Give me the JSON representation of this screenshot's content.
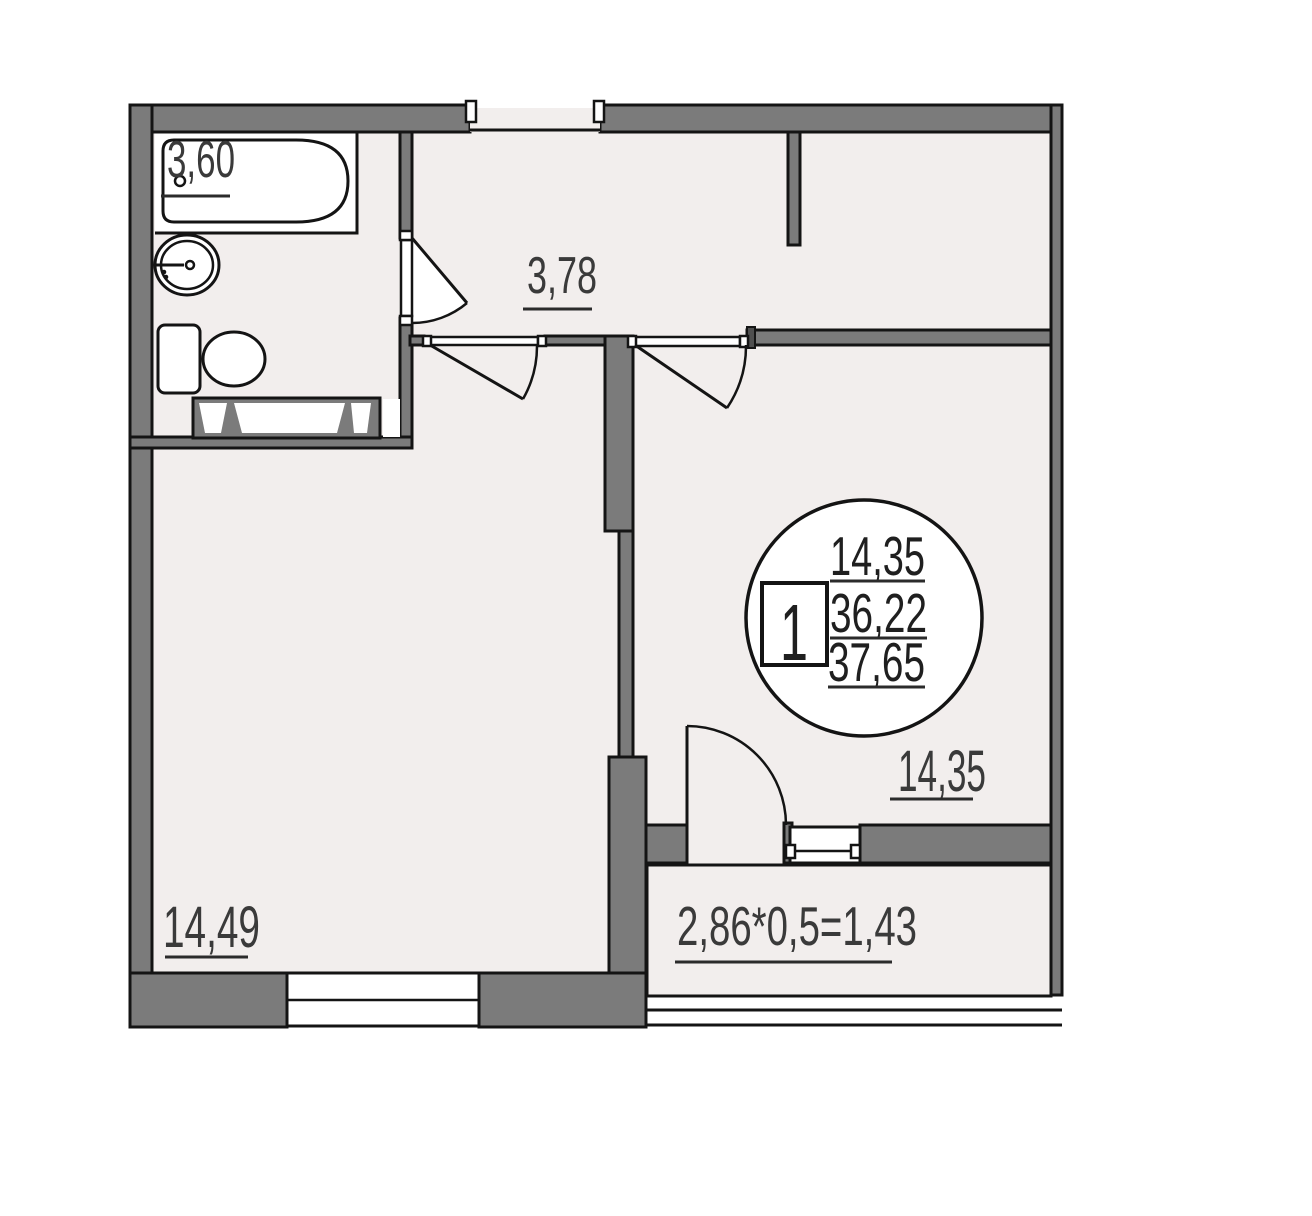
{
  "areas": {
    "bathroom": "3,60",
    "hallway": "3,78",
    "room_left": "14,49",
    "room_right": "14,35",
    "balcony": "2,86*0,5=1,43"
  },
  "stamp": {
    "rooms_count": "1",
    "living_area": "14,35",
    "area_without_balcony": "36,22",
    "area_total": "37,65"
  },
  "fixtures": {
    "bathtub": "bathtub",
    "wash_basin": "wash-basin",
    "toilet": "toilet",
    "ventilation_duct": "ventilation-duct"
  },
  "colors": {
    "wall": "#7b7b7b",
    "floor": "#f2eeed",
    "outline": "#141414",
    "label_text": "#3a3a3a",
    "fixture_fill": "#ffffff"
  }
}
